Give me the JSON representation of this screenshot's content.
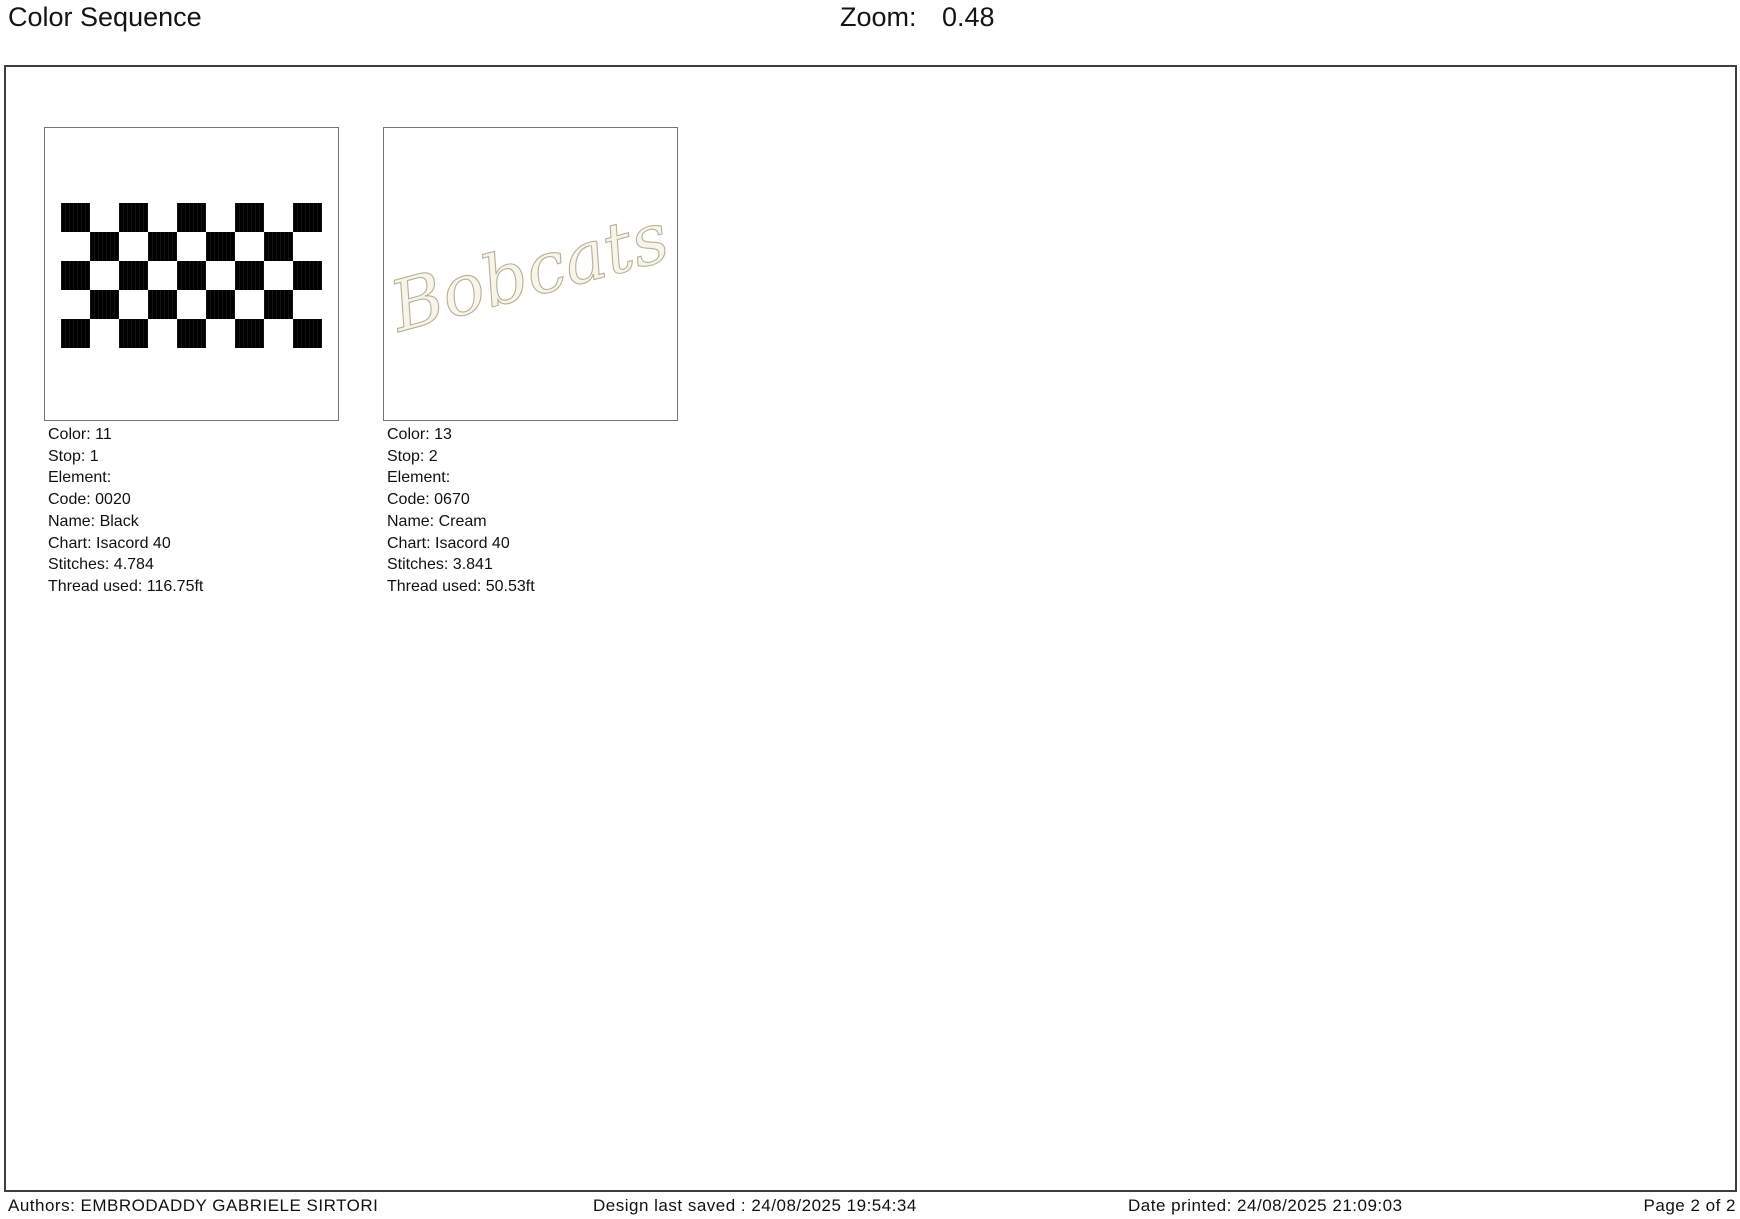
{
  "header": {
    "title": "Color Sequence",
    "zoom_label": "Zoom:",
    "zoom_value": "0.48"
  },
  "colors": [
    {
      "thumbnail": "checkerboard",
      "pattern": {
        "rows": 5,
        "cols": 9,
        "cell_colors": [
          "#000000",
          "#ffffff"
        ]
      },
      "lines": [
        "Color: 11",
        "Stop: 1",
        "Element:",
        "Code: 0020",
        "Name: Black",
        "Chart: Isacord 40",
        "Stitches: 4.784",
        "Thread used: 116.75ft"
      ]
    },
    {
      "thumbnail": "script-text",
      "script_text": "Bobcats",
      "script_fill": "#f7f5e9",
      "script_stroke": "#b3b296",
      "lines": [
        "Color: 13",
        "Stop: 2",
        "Element:",
        "Code: 0670",
        "Name: Cream",
        "Chart: Isacord 40",
        "Stitches: 3.841",
        "Thread used: 50.53ft"
      ]
    }
  ],
  "footer": {
    "authors": "Authors: EMBRODADDY GABRIELE SIRTORI",
    "design_saved": "Design last saved : 24/08/2025 19:54:34",
    "date_printed": "Date printed: 24/08/2025 21:09:03",
    "page": "Page 2 of 2"
  }
}
